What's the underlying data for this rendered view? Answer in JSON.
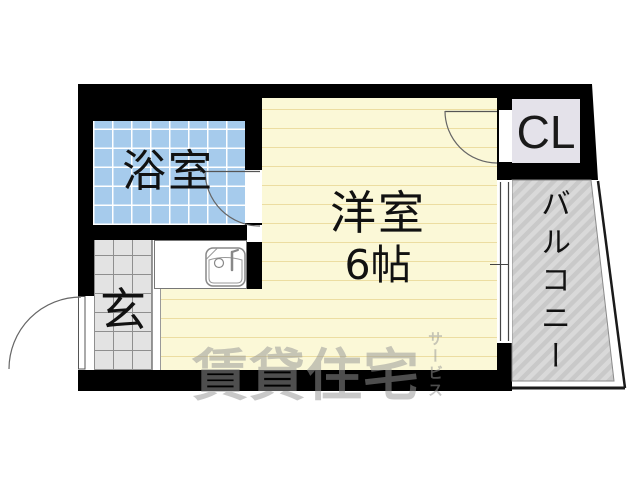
{
  "floorplan": {
    "type": "apartment-floor-plan",
    "rooms": {
      "bathroom": {
        "label": "浴室"
      },
      "entrance": {
        "label": "玄"
      },
      "main_room": {
        "label": "洋室",
        "size_label": "6帖"
      },
      "closet": {
        "label": "CL"
      },
      "balcony": {
        "label": "バルコニー"
      }
    },
    "watermark": {
      "text": "賃貸住宅",
      "subtext": "サービス"
    },
    "colors": {
      "wall": "#000000",
      "bathroom_floor": "#A6CBEC",
      "bathroom_grid": "#FFFFFF",
      "entrance_floor": "#E3E3E3",
      "main_room_floor": "#FBF8D7",
      "main_room_lines": "#ECDDA1",
      "closet_floor": "#E4E2EA",
      "balcony_floor": "#C9C9C9",
      "balcony_stripe": "#D9D9D9",
      "watermark": "#969696"
    },
    "icons": {
      "sink": "sink-icon",
      "entrance_door": "door-swing-icon",
      "bathroom_door": "door-swing-icon",
      "closet_door": "door-swing-icon",
      "window": "sliding-window-icon",
      "balcony_hatch": "diagonal-hatch-pattern"
    }
  }
}
